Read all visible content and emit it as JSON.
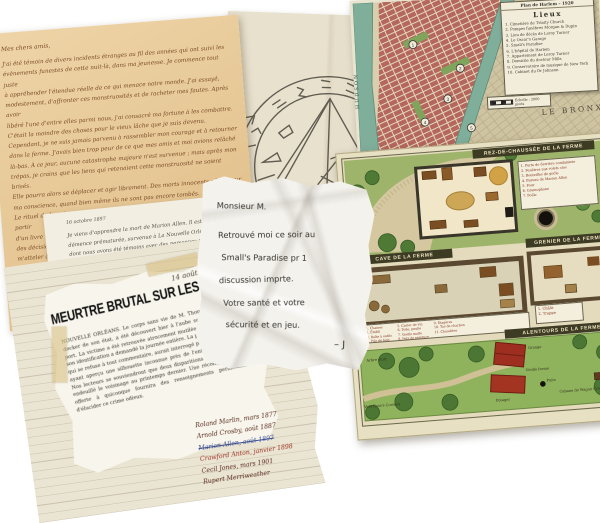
{
  "colors": {
    "background": "#ffffff",
    "orange_paper": "#e6c795",
    "orange_ink": "#7a4a26",
    "parchment": "#e6dfcb",
    "sigil_ink": "#4a463c",
    "map_blocks_red": "#b5665d",
    "map_river_teal": "#7fae9b",
    "farm_grass_green": "#96b061",
    "barn_red": "#9e2e1f",
    "banner_olive": "#3e3b24",
    "ink_dark_red": "#5a2a1c",
    "ink_bright_red": "#9c3020",
    "ink_blue": "#3a4e8e"
  },
  "orange_letter": {
    "salutation": "Mes chers amis,",
    "body": "J'ai été témoin de divers incidents étranges au fil des années qui ont suivi les\névénements funestes de cette nuit-là, dans ma jeunesse. Je commence tout juste\nà appréhender l'étendue réelle de ce qui menace notre monde. J'ai essayé,\nmodestement, d'affronter ces monstruosités et de racheter mes fautes. Après avoir\nlibéré l'une d'entre elles parmi nous, j'ai consacré ma fortune à les combattre.\nC'était la moindre des choses pour le vieux lâche que je suis devenu.\nCependant, je ne suis jamais parvenu à rassembler mon courage et à retourner\ndans la ferme. J'avais bien trop peur de ce que mes amis et moi avions relâché\nlà-bas. À ce jour, aucune catastrophe majeure n'est survenue ; mais après mon\ntrépas, je crains que les liens qui retenaient cette monstruosité ne soient brisés.\nElle pourra alors se déplacer et agir librement. Des morts innocents pèsent sur\nma conscience, quand bien même ils ne sont pas encore tombés.\nLe rituel de bannissement se base sur les traductions réalisées par Marion à partir\nd'un livre nommé De Vermis Mysteriis. Nous en avons consigné les détails et\ndes décisions que nous avons prises alors. Je vous supplie, mes chers amis, de\nm'atteler à cette tâche si je venais à disparaître avant d'avoir pu bannir la\nmonstruosité qui sommeille encore sous les poutres de la vieille ferme.\nCar j'ai la faiblesse de croire qu'il est encore temps d'agir et de\nsauver nos âmes du châtiment qui les guette.\nJe ne veux pas que ce fardeau repose sur d'autres\népaules."
  },
  "white_letter": {
    "date": "16 octobre 1897",
    "body": "Je viens d'apprendre la mort de Marion Allen. Il est décédé il y a quelques mois,\ndémence prématurée, survenue à La Nouvelle Orléans. Je crains qu'il n'ait partagé ce\ndont nous avons été témoins avec des personnes peu recommandables, qui l'ont exploité.\nL'article mentionne la sinistre boîte en os. Ses excellents desseins peuvent être en péril.\nQuoi qu'il en soit, tous d'entre nous sont maintenant morts. Je dois faire vite.\nJ'ai commencé un cours d'histoire ancienne à l'Université, et je pense que j'en\nsaurai plus sur ce qui s'est passé à la ferme. Peut-être découvrirai-je par mes moyens\ncomment débarrasser notre monde de la bête ?"
  },
  "note": {
    "line1": "Monsieur M.",
    "line2": "Retrouvé moi ce soir au",
    "line3": "Small's Paradise pr 1",
    "line4": "discussion imprte.",
    "line5": "Votre santé et votre",
    "line6": "sécurité et en jeu.",
    "signature": "– J"
  },
  "clipping": {
    "date": "14 août 1887",
    "headline": "MEURTRE BRUTAL SUR LES QUAIS",
    "body": "NOUVELLE ORLÉANS. Le corps sans vie de M. Thomas Delancre, docker de son état, a été découvert hier à l'aube sur les quais du port. La victime a été retrouvée atrocement mutilée, à tel point que son identification a demandé la journée entière. La police du district, qui se refuse à tout commentaire, aurait interrogé plusieurs témoins ayant aperçu une silhouette inconnue près de l'entrepôt Pommier. Nos lecteurs se souviendront que deux disparitions semblables ont endeuillé le voisinage au printemps dernier. Une récompense sera offerte à quiconque fournira des renseignements permettant d'élucider ce crime odieux."
  },
  "names": [
    {
      "text": "Roland Marlin, mars 1877"
    },
    {
      "text": "Arnold Crosby, août 1887"
    },
    {
      "text": "Marion Allen, août 1897"
    },
    {
      "text": "Crawford Anton, janvier 1898"
    },
    {
      "text": "Cecil Jones, mars 1901"
    },
    {
      "text": "Rupert Merriweather"
    }
  ],
  "harlem_map": {
    "legend_title": "Plan de Harlem – 1920",
    "legend_heading": "Lieux",
    "items": [
      "1. Cimetière de Trinity Church",
      "2. Pompes funèbres Morgan & Dupin",
      "3. Lieu de décès de Leroy Turner",
      "4. Le Oscar's Garage",
      "5. Small's Paradise",
      "6. L'hôpital de Harlem",
      "7. Appartement de Leroy Turner",
      "8. Domicile du docteur Mills",
      "9. Conservatoire de musique de New York",
      "10. Cabinet du Dr Johnson"
    ],
    "scale_label": "Échelle : 2000 pieds",
    "bronx_label": "LE BRONX",
    "hudson_label": "HUDSON",
    "markers": [
      "1",
      "2",
      "3",
      "4",
      "5"
    ]
  },
  "farm_map": {
    "ground_header": "REZ-DE-CHAUSSÉE DE LA FERME",
    "cellar_header": "CAVE DE LA FERME",
    "attic_header": "GRENIER DE LA FERME",
    "surroundings_header": "ALENTOURS DE LA FERME",
    "ground_legend": [
      "1. Porte de derrière condamnée",
      "2. Fenêtres aux volets clos",
      "3. Bouteilles de gnôle",
      "4. Bureau de Marion Allen",
      "5. Four",
      "6. Gramophone",
      "7. Poêle"
    ],
    "attic_legend": [
      "1. Châlit",
      "2. Trappe"
    ],
    "cellar_col1": [
      "1. Chaises",
      "2. Établi",
      "3. Boîte à outils",
      "4. Pile de bois"
    ],
    "cellar_col2": [
      "5. Casier de vin",
      "6. Toile, poulie",
      "7. Vieille malle",
      "8. Pots de peinture"
    ],
    "cellar_col3": [
      "9. Étagères",
      "10. Tas de charbon",
      "11. Chaudière"
    ],
    "labels": {
      "dead_tree": "Arbre mort",
      "to_town": "Vers Ross's Corners",
      "barn": "Grange",
      "farmhouse": "Vieille ferme",
      "well": "Puits",
      "garden": "Potager",
      "shack": "Cabane de Wagon Creek"
    }
  }
}
